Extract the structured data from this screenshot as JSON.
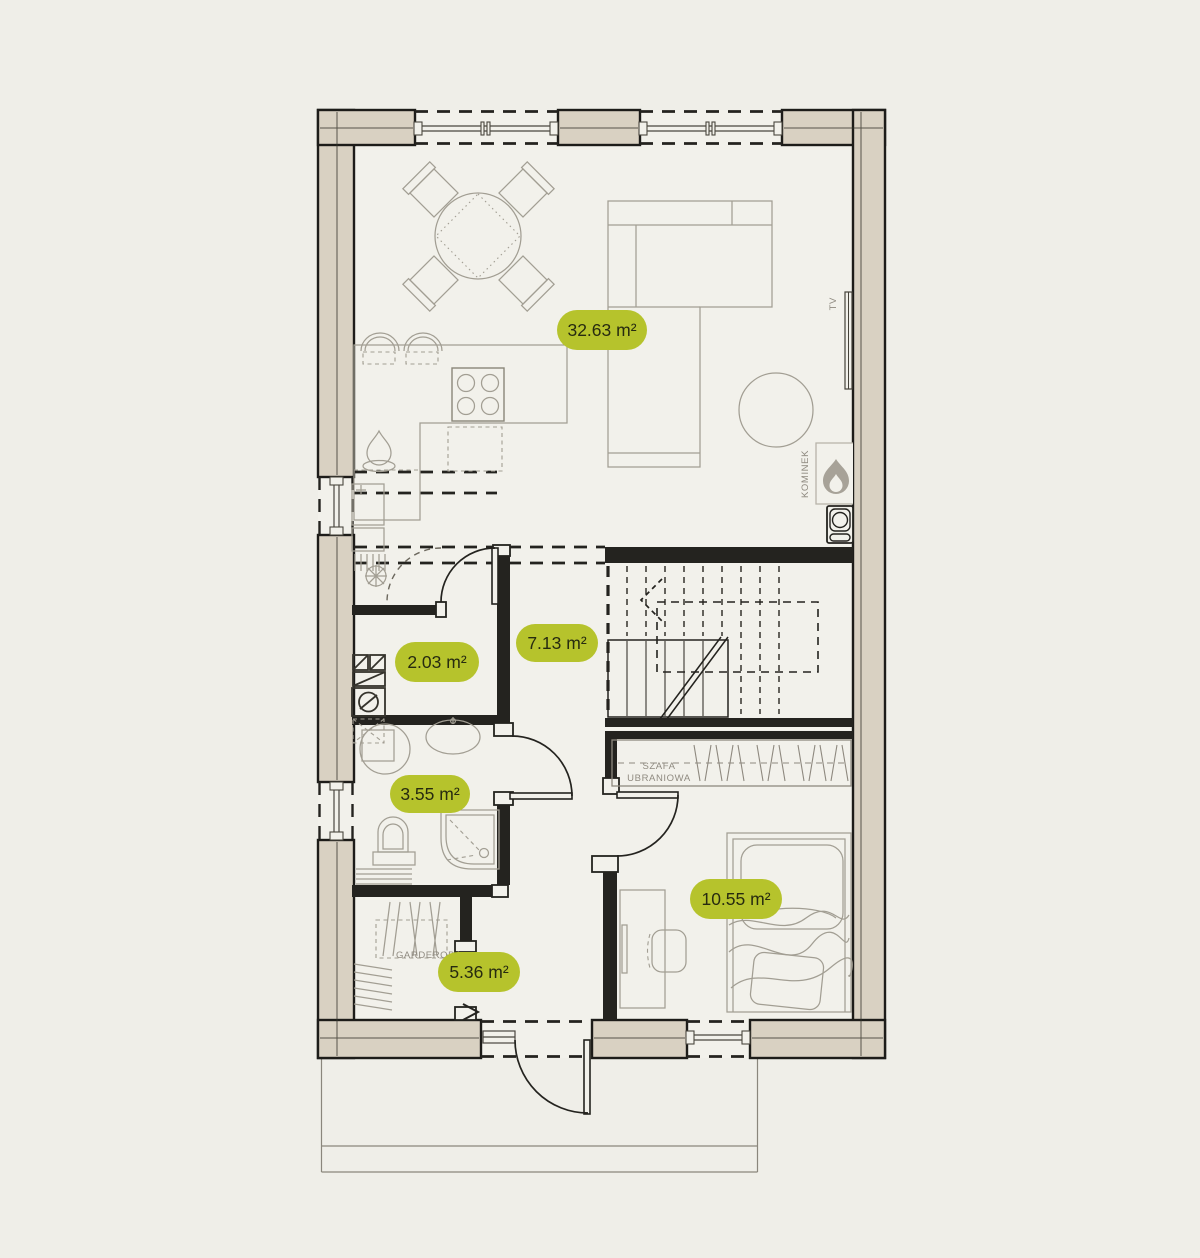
{
  "colors": {
    "background": "#efeee8",
    "floor": "#f2f1eb",
    "wall_fill": "#d9d1c2",
    "wall_line": "#1d1c19",
    "furniture_line": "#a29e93",
    "label_bg": "#b6c32c",
    "label_text": "#272b10",
    "annotation_text": "#8f8a80"
  },
  "rooms": [
    {
      "id": "living-room-kitchen",
      "area": "32.63 m²"
    },
    {
      "id": "wc-laundry",
      "area": "2.03 m²"
    },
    {
      "id": "hall",
      "area": "7.13 m²"
    },
    {
      "id": "bathroom",
      "area": "3.55 m²"
    },
    {
      "id": "wardrobe-room",
      "area": "5.36 m²"
    },
    {
      "id": "bedroom",
      "area": "10.55 m²"
    }
  ],
  "annotations": {
    "fireplace": "KOMINEK",
    "tv": "TV",
    "closet_line1": "SZAFA",
    "closet_line2": "UBRANIOWA",
    "garderobe": "GARDEROBA"
  }
}
